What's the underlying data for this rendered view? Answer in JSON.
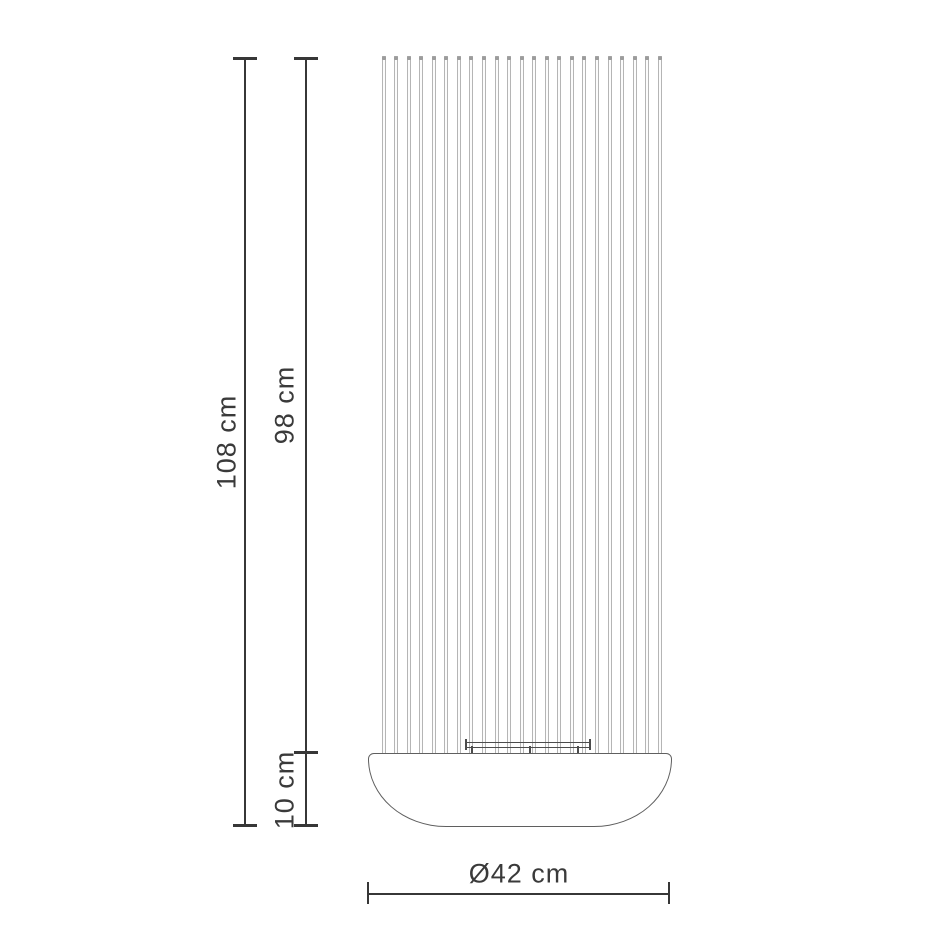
{
  "figure": {
    "rod_count": 23
  },
  "dimensions": {
    "total_height": "108 cm",
    "rod_section_height": "98 cm",
    "base_height": "10 cm",
    "base_diameter": "Ø42 cm"
  },
  "colors": {
    "background": "#ffffff",
    "dimension_line": "#373737",
    "label_text": "#3a3a3a",
    "rod_edge": "#b5b5b5",
    "rod_cap": "#9c9c9c",
    "base_outline": "#5f5f5f",
    "bracket": "#4c4c4c"
  }
}
